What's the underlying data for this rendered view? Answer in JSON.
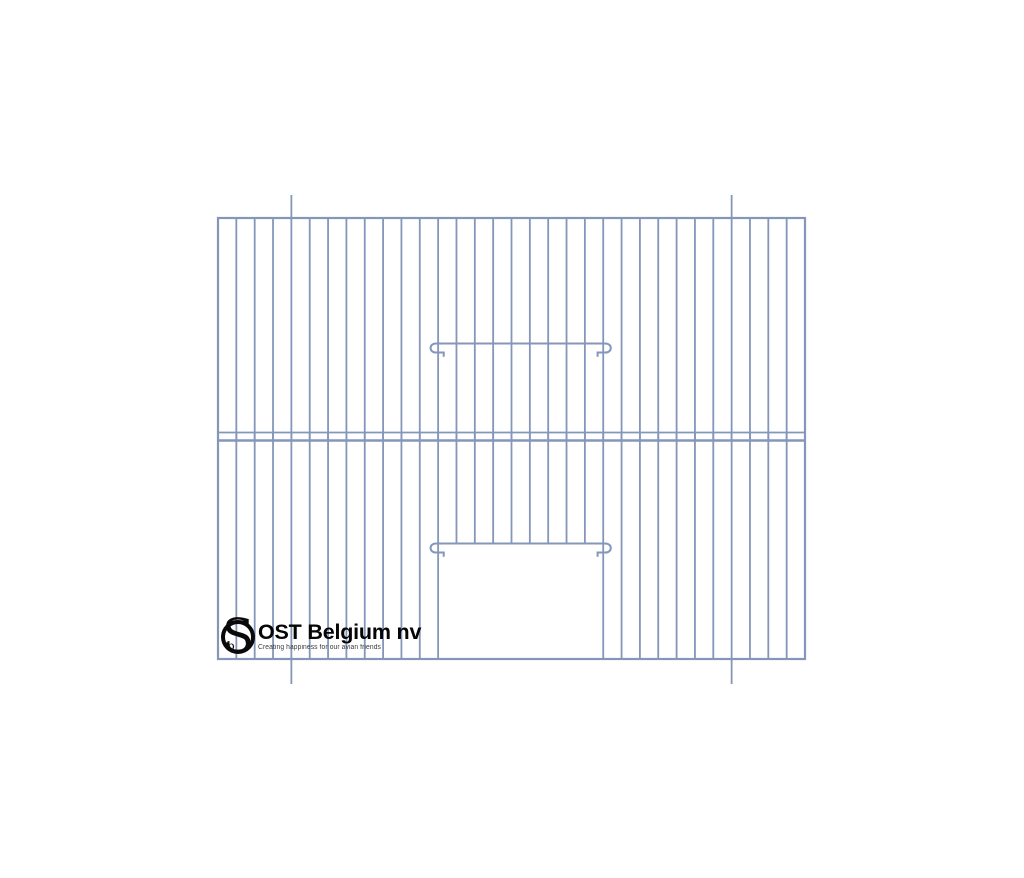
{
  "page": {
    "background_color": "#ffffff",
    "description": "Product drawing of a wire bird-cage front panel with sliding door"
  },
  "logo": {
    "monogram_letter": "S",
    "monogram_small_letter": "b",
    "company_name": "OST Belgium nv",
    "tagline": "Creating happiness for our avian friends",
    "text_color": "#050505",
    "tagline_color": "#3a3a3a"
  },
  "diagram": {
    "type": "cage-front-panel",
    "wire_color": "#8496ba",
    "bar_stroke_width": 1.8,
    "frame_stroke_width": 2.2,
    "slide_stroke_width": 2,
    "panel": {
      "left": 218,
      "top": 218,
      "right": 805,
      "bottom": 659
    },
    "vertical_gap_count": 32,
    "middle_rail_ys": [
      432.5,
      440.5
    ],
    "middle_rail_widths": [
      1.8,
      2.4
    ],
    "door": {
      "left_bar_index": 12,
      "right_bar_index": 21,
      "upper_slide_y": 343.5,
      "lower_slide_y": 543.5
    },
    "protruding_bar_indices": [
      4,
      28
    ],
    "protrusion_top": 23,
    "protrusion_bottom": 25
  }
}
